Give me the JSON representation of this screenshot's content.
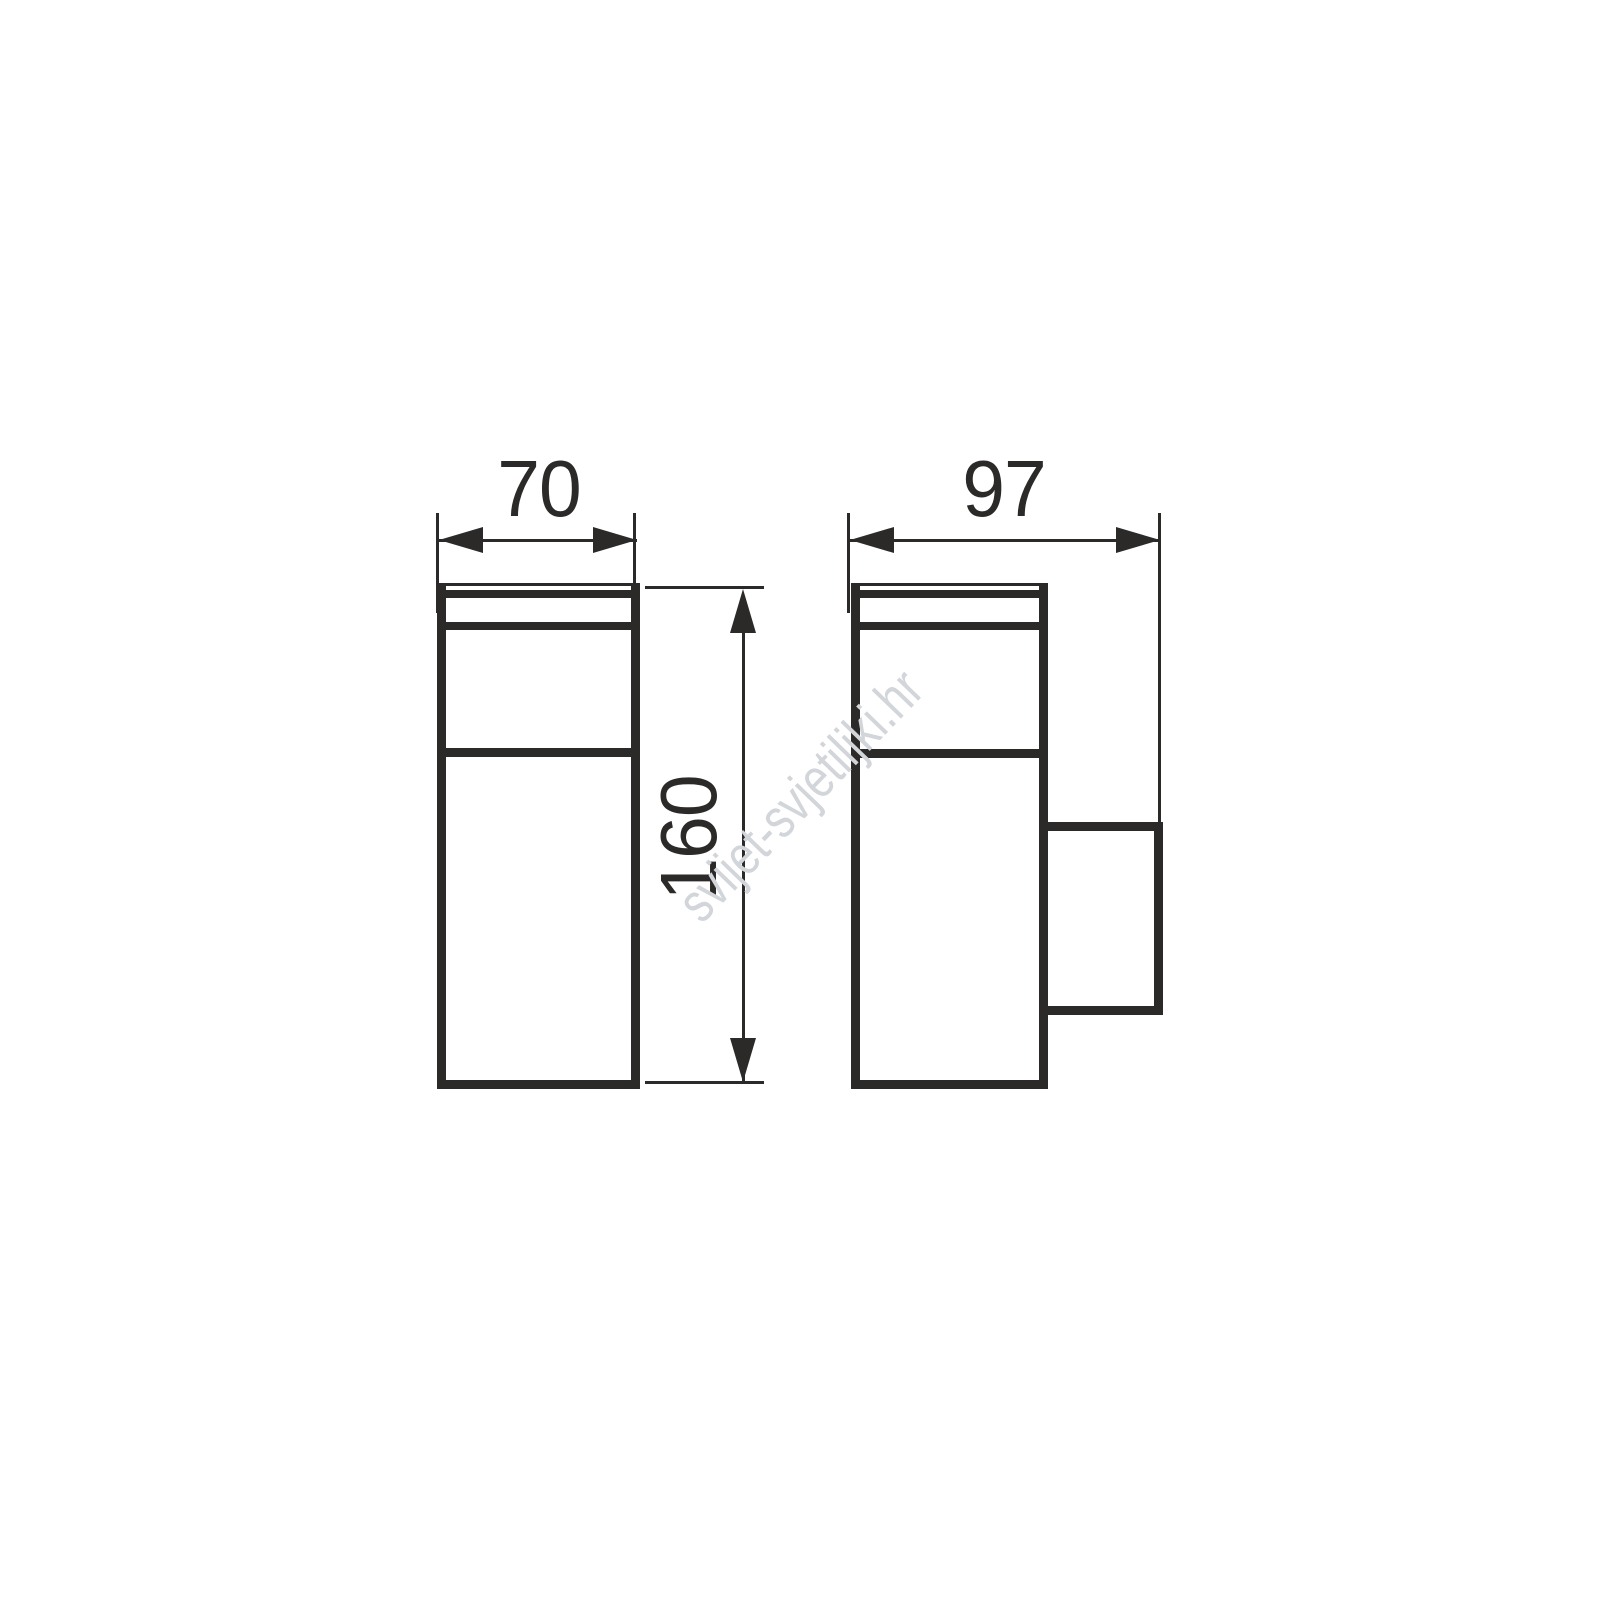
{
  "drawing": {
    "title": "wall-luminaire-dimension-drawing",
    "views": [
      {
        "id": "front-view",
        "description": "front elevation of rectangular wall lamp with top cap, diffuser band and body"
      },
      {
        "id": "side-view",
        "description": "side elevation of wall lamp with rear wall-mount bracket"
      }
    ],
    "dimensions": {
      "front_width": "70",
      "height": "160",
      "side_depth": "97"
    }
  },
  "watermark": {
    "text": "svijet-svjetiljki.hr"
  },
  "colors": {
    "ink": "#2b2a29",
    "watermark": "#d2d5d9",
    "background": "#ffffff"
  }
}
